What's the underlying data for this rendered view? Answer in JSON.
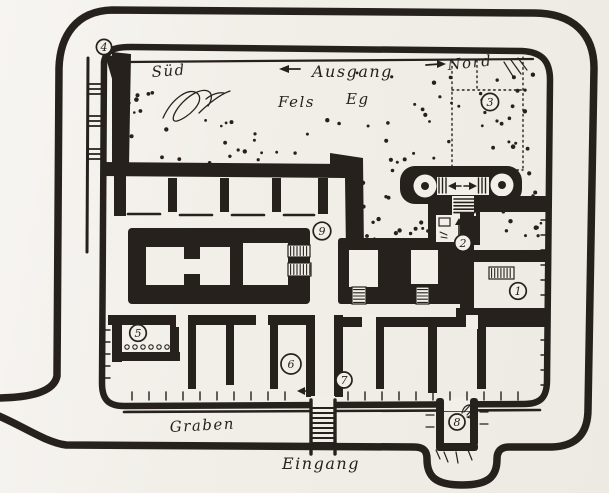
{
  "colors": {
    "ink": "#26211d",
    "paper": "#f2efe9"
  },
  "labels": {
    "sued": "Süd",
    "ausgang": "Ausgang",
    "nord": "Nord",
    "fels": "Fels",
    "eg": "Eg",
    "graben": "Graben",
    "eingang": "Eingang"
  },
  "icons": {
    "ausgang_arrow": "arrow-left",
    "nord_arrow": "arrow-right",
    "entrance_arrow": "arrow-left",
    "stairs_up_arrow": "arrow-up",
    "gate_arrows": "arrow-left-right",
    "round_stair": "spiral-stairs",
    "bridge": "ladder-bridge"
  },
  "markers": [
    {
      "label": "1"
    },
    {
      "label": "2"
    },
    {
      "label": "3"
    },
    {
      "label": "4"
    },
    {
      "label": "5"
    },
    {
      "label": "6"
    },
    {
      "label": "7"
    },
    {
      "label": "8"
    },
    {
      "label": "9"
    }
  ]
}
